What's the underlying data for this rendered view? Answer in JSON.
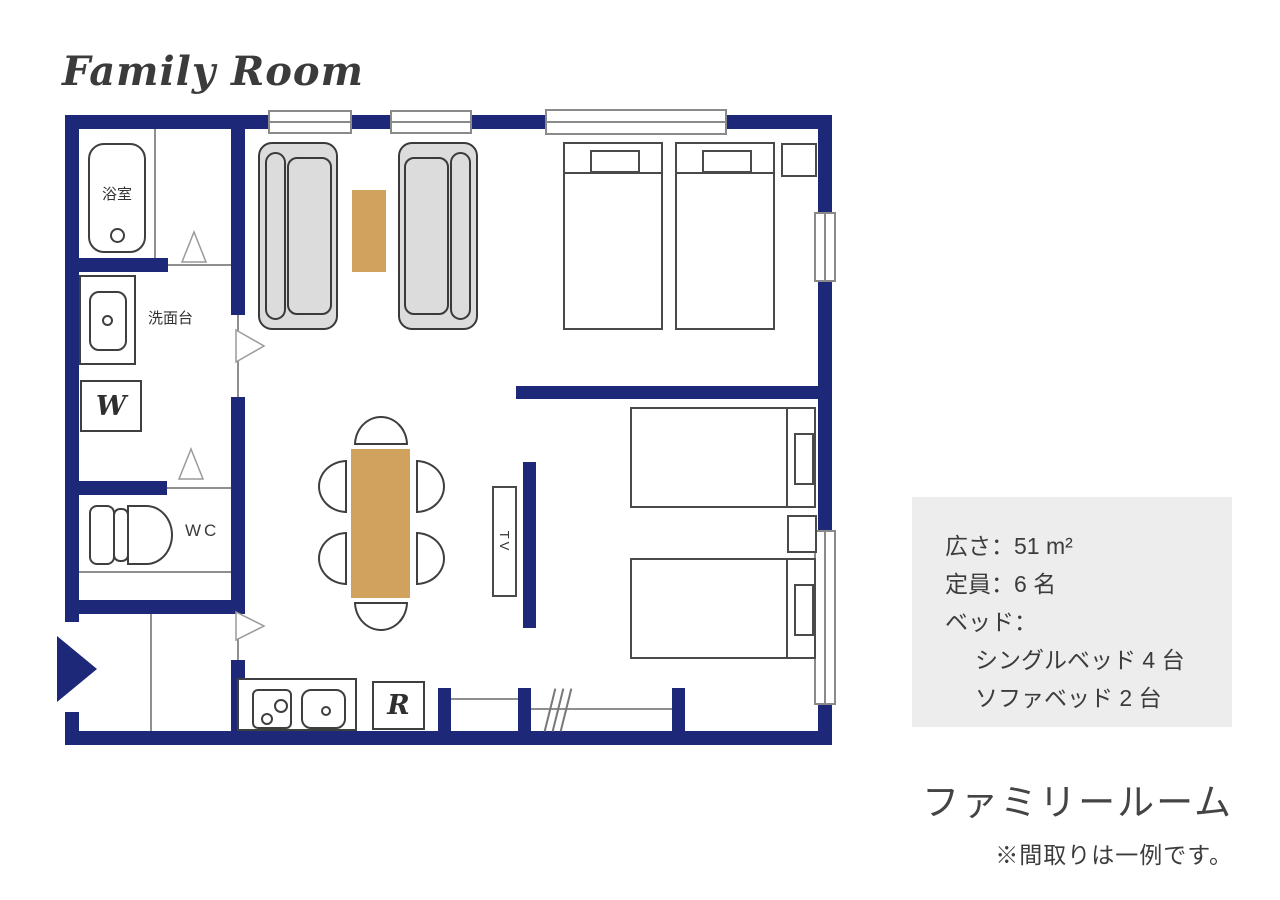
{
  "title": "Family Room",
  "plan_labels": {
    "bath": "浴室",
    "washstand": "洗面台",
    "washer": "W",
    "wc": "WC",
    "tv": "TV",
    "fridge": "R"
  },
  "info_box": {
    "area_line": "広さ：51 m²",
    "capacity_line": "定員：6 名",
    "bed_line": "ベッド：",
    "bed_detail_1": "シングルベッド 4 台",
    "bed_detail_2": "ソファベッド 2 台"
  },
  "room_name": "ファミリールーム",
  "disclaimer": "※間取りは一例です。",
  "colors": {
    "wall_navy": "#1e2878",
    "table_wood": "#d0a25e",
    "sofa_gray": "#dcdcdc",
    "info_box_bg": "#ededed",
    "text_dark": "#3c3c3c"
  }
}
